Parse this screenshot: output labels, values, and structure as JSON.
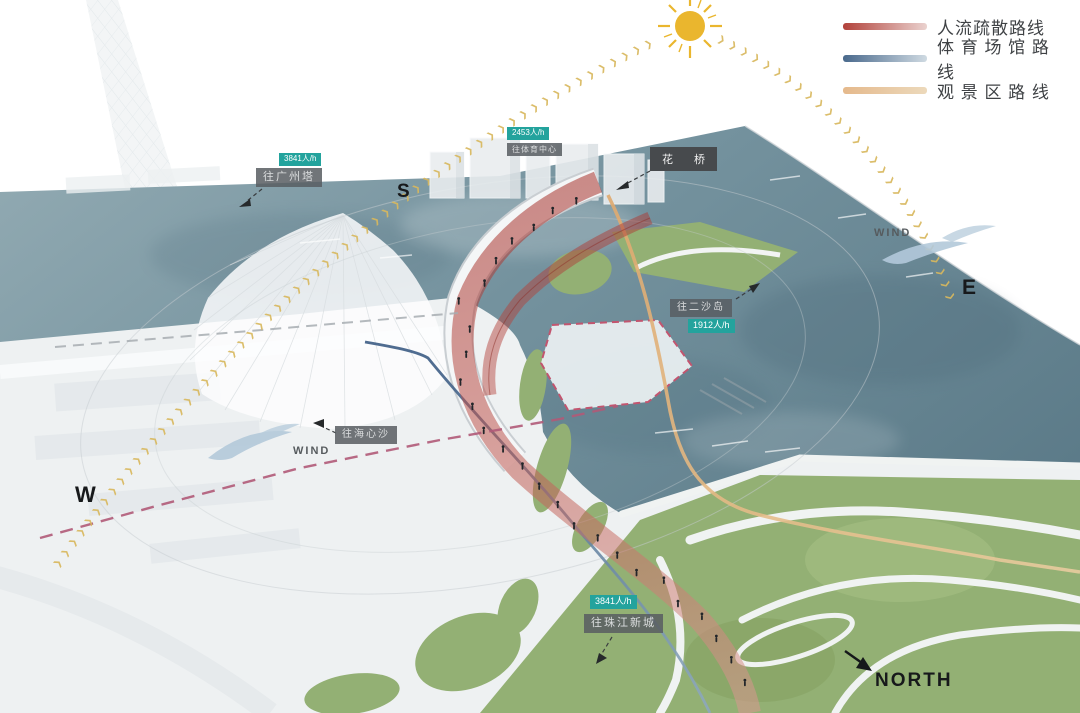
{
  "legend": {
    "items": [
      {
        "id": "evacuation-route",
        "label": "人流疏散路线",
        "color_from": "#b2423b",
        "color_to": "#ead2cf"
      },
      {
        "id": "sports-venue-route",
        "label": "体 育 场 馆 路 线",
        "color_from": "#49698c",
        "color_to": "#cfdae2"
      },
      {
        "id": "scenic-area-route",
        "label": "观 景 区 路 线",
        "color_from": "#e5b98c",
        "color_to": "#ecd9bb"
      }
    ]
  },
  "compass": {
    "south": "S",
    "east": "E",
    "west": "W",
    "north": "NORTH"
  },
  "wind_labels": {
    "west": "WIND",
    "east": "WIND"
  },
  "bridge_label": "花 桥",
  "annotations": [
    {
      "id": "canton-tower",
      "flow": "3841人/h",
      "dest": "往广州塔"
    },
    {
      "id": "sports-center",
      "flow": "2453人/h",
      "dest": "往体育中心"
    },
    {
      "id": "ersha-island",
      "flow": "1912人/h",
      "dest": "往二沙岛"
    },
    {
      "id": "zhujiang-new-town",
      "flow": "3841人/h",
      "dest": "往珠江新城"
    },
    {
      "id": "haixinsha",
      "dest": "往海心沙"
    }
  ],
  "icons": {
    "sun": "sun-icon",
    "chevron": "❯",
    "north_arrow": "arrow",
    "wind_swoosh": "wind-swoosh-icon"
  },
  "colors": {
    "route_evacuation": "#b2423b",
    "route_sports": "#49698c",
    "route_scenic": "#dfa96e",
    "water": "#74929e",
    "park": "#93b074",
    "badge_teal": "#23a39d",
    "badge_gray": "#5b6064",
    "sun": "#eab62e",
    "sun_path": "#d8b85e",
    "dashed_magenta": "#b05a78"
  }
}
